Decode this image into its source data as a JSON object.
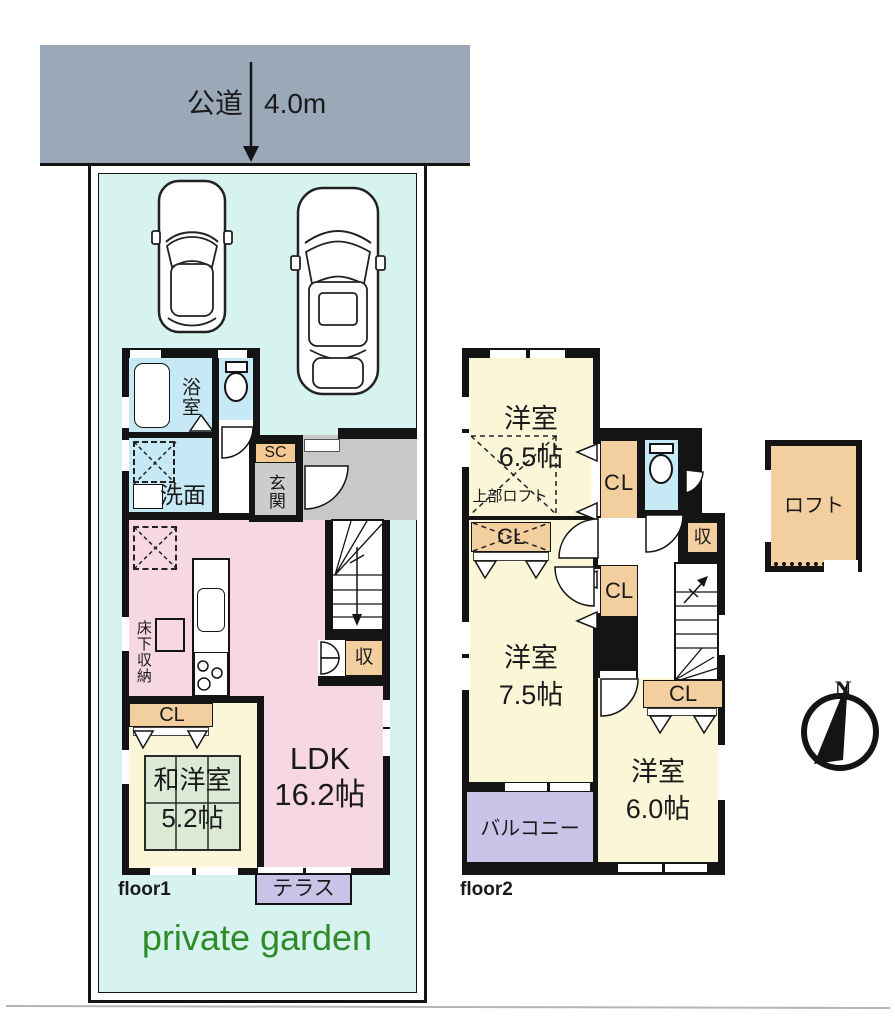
{
  "road": {
    "label": "公道",
    "width": "4.0m"
  },
  "site": {
    "garden": "private garden"
  },
  "floor1": {
    "label": "floor1",
    "bath": "浴室",
    "washroom": "洗面",
    "shoe_closet": "SC",
    "entrance": "玄関",
    "underfloor_storage": "床下収納",
    "closet": "CL",
    "storage": "収",
    "tatami_room": {
      "name": "和洋室",
      "size": "5.2帖"
    },
    "ldk": {
      "name": "LDK",
      "size": "16.2帖"
    },
    "terrace": "テラス"
  },
  "floor2": {
    "label": "floor2",
    "room_65": {
      "name": "洋室",
      "size": "6.5帖",
      "note": "上部ロフト"
    },
    "room_75": {
      "name": "洋室",
      "size": "7.5帖"
    },
    "room_60": {
      "name": "洋室",
      "size": "6.0帖"
    },
    "closet": "CL",
    "storage": "収",
    "balcony": "バルコニー"
  },
  "loft": {
    "label": "ロフト"
  },
  "compass": {
    "north": "N"
  },
  "colors": {
    "road_gray": "#9aa8b8",
    "lot_cyan": "#d7f3ef",
    "room_cream": "#fcf6d9",
    "ldk_pink": "#f8d7e4",
    "wet_blue": "#c7e9f5",
    "closet_tan": "#f3cfa0",
    "balcony_lavender": "#c8c4e8",
    "tatami_green": "#dbead5",
    "entrance_gray": "#cbcdcc",
    "garden_green": "#2e8b28",
    "wall_black": "#141414"
  }
}
